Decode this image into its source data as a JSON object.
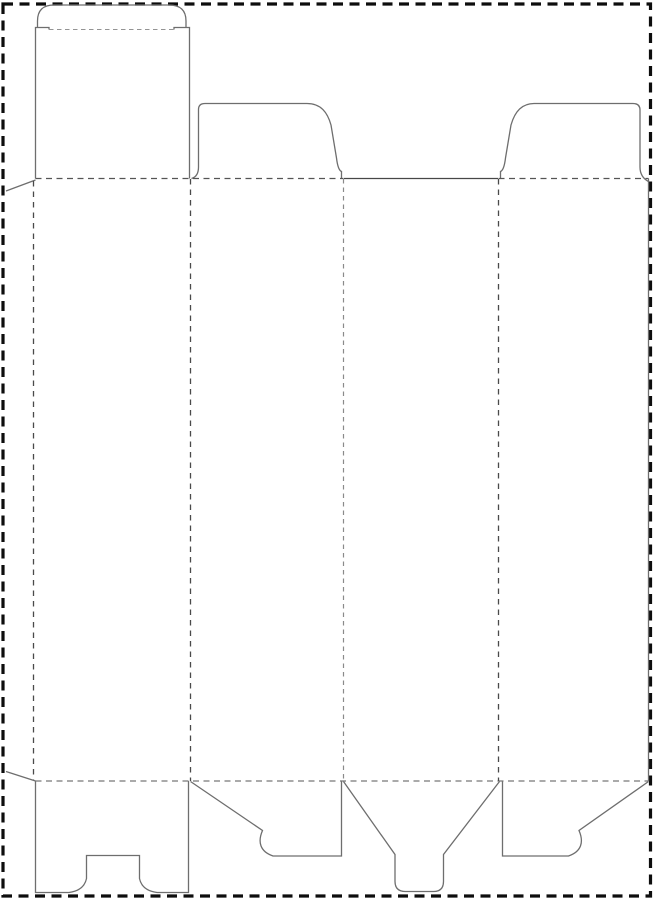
{
  "figure": {
    "kind": "packaging-dieline-template",
    "canvas": {
      "width": 654,
      "height": 900,
      "background": "#ffffff"
    },
    "styles": {
      "border": {
        "color": "#0d0d0d",
        "width": 3.2,
        "dash": "10 6.5"
      },
      "cut": {
        "color": "#6e6e6e",
        "width": 1.3,
        "dash": ""
      },
      "cutDark": {
        "color": "#474747",
        "width": 1.3,
        "dash": ""
      },
      "foldDark": {
        "color": "#555555",
        "width": 1.3,
        "dash": "6 4.5"
      },
      "foldMid": {
        "color": "#777777",
        "width": 1.3,
        "dash": "6 4.5"
      },
      "foldV": {
        "color": "#4a4a4a",
        "width": 1.3,
        "dash": "5.5 5"
      },
      "foldVLight": {
        "color": "#8a8a8a",
        "width": 1.2,
        "dash": "4.5 4"
      },
      "foldLight": {
        "color": "#949494",
        "width": 1.1,
        "dash": "4.5 3.5"
      }
    },
    "paths": [
      {
        "name": "page-margin-border",
        "style": "border",
        "d": "M 3,4 L 650.5,4 L 650.5,896 L 3,896 Z"
      },
      {
        "name": "lid-left-edge-and-shoulder",
        "style": "cut",
        "d": "M 35.5,178.5 L 35.5,27.5 L 49,27.5 L 49,29.5"
      },
      {
        "name": "lid-right-edge-and-shoulder",
        "style": "cut",
        "d": "M 174,29.5 L 174,27.5 L 189.5,27.5 L 189.5,178.5"
      },
      {
        "name": "tuck-flap-outline",
        "style": "cut",
        "d": "M 37.5,27.5 L 37.5,21 Q 37.5,5 54,5 L 169,5 Q 186,5 186,21 L 186,27.5"
      },
      {
        "name": "dust-flap-panel2-outline",
        "style": "cut",
        "d": "M 191.5,178.5 Q 198.5,176.5 198.5,167 L 198.5,109.5 Q 198.5,103.5 205,103.5 L 307,103.5 C 321,103.5 327.5,112.5 331,125 L 336.5,158 C 337.5,166.5 339,170.5 341.5,171.5 L 341.5,178.5"
      },
      {
        "name": "panel3-top-cut-edge",
        "style": "cutDark",
        "d": "M 343.5,178.5 L 498,178.5"
      },
      {
        "name": "dust-flap-panel4-outline",
        "style": "cut",
        "d": "M 500.5,178.5 L 500.5,171.5 C 503,170.5 504.5,166.5 505.5,158 L 511,125 C 514.5,112.5 521.5,103.5 534,103.5 L 633,103.5 Q 640,103.5 640,110 L 640,167 Q 640,177 648.5,181.5"
      },
      {
        "name": "panel4-right-cut-edge",
        "style": "cut",
        "d": "M 648.5,178.5 L 648.5,781"
      },
      {
        "name": "glue-flap-top-slant",
        "style": "cut",
        "d": "M 35.5,180 L 6,191"
      },
      {
        "name": "glue-flap-bottom-slant",
        "style": "cut",
        "d": "M 6,771.5 L 35.5,781"
      },
      {
        "name": "bottom-flap-panel1-notched-outline",
        "style": "cut",
        "d": "M 35.5,781 L 35.5,892.5 L 69,892.5 Q 84,890.5 86.5,878.5 L 86.5,855.5 L 139.5,855.5 L 139.5,878.5 Q 142,890.5 157,892.5 L 188.5,892.5 L 188.5,781"
      },
      {
        "name": "bottom-flap-panel2-outline",
        "style": "cut",
        "d": "M 190.5,781.5 L 262.5,830.5 C 257.5,842 260,851.5 273,856 L 341.5,856 L 341.5,781.5"
      },
      {
        "name": "bottom-tuck-funnel-panel3-outline",
        "style": "cut",
        "d": "M 343.5,781.5 L 395,854.5 L 395,881.5 Q 395,891.5 405.5,891.5 L 433.5,891.5 Q 443.5,891.5 443.5,881.5 L 443.5,854.5 L 499.5,781.5"
      },
      {
        "name": "bottom-flap-panel4-outline",
        "style": "cut",
        "d": "M 502.5,781.5 L 502.5,856 L 568.5,856 C 581.5,851.5 584,842 579,830.5 L 648.5,781.5"
      },
      {
        "name": "tuck-flap-fold-line",
        "style": "foldLight",
        "d": "M 49,29.5 L 174,29.5"
      },
      {
        "name": "top-fold-line-left",
        "style": "foldDark",
        "d": "M 35.5,178.5 L 343,178.5"
      },
      {
        "name": "top-fold-line-right",
        "style": "foldDark",
        "d": "M 498.5,178.5 L 648.5,178.5"
      },
      {
        "name": "bottom-fold-line",
        "style": "foldMid",
        "d": "M 35.5,781 L 648.5,781"
      },
      {
        "name": "glue-flap-fold-line",
        "style": "foldV",
        "d": "M 33.5,181 L 33.5,780"
      },
      {
        "name": "fold-line-panel1-panel2",
        "style": "foldV",
        "d": "M 190.5,179 L 190.5,781"
      },
      {
        "name": "fold-line-panel2-panel3",
        "style": "foldVLight",
        "d": "M 343.5,179 L 343.5,781"
      },
      {
        "name": "fold-line-panel3-panel4",
        "style": "foldV",
        "d": "M 498.5,179 L 498.5,781"
      }
    ]
  }
}
